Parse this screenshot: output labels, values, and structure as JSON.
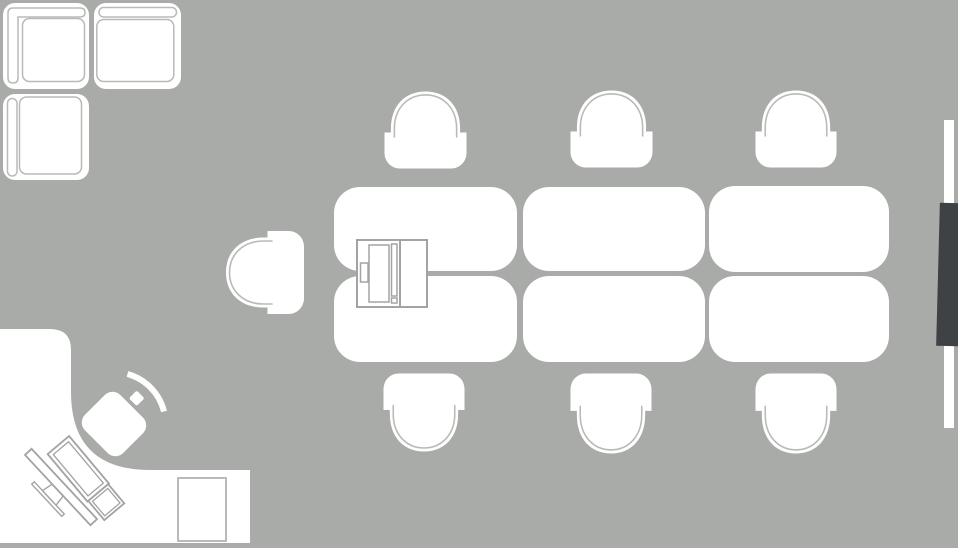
{
  "scene": {
    "label": "meeting-room-floor-plan",
    "canvas": {
      "width_px": 958,
      "height_px": 548
    },
    "furniture_inventory": [
      "corner-sofa (3 modules)",
      "lounge-chair",
      "conference-table (6 segments)",
      "6 conference chairs",
      "printer",
      "l-shaped-desk",
      "office-chair",
      "monitor",
      "keyboard",
      "cabinet",
      "wall-board",
      "tv-screen"
    ]
  },
  "colors": {
    "floor": "#a9aba8",
    "furniture": "#ffffff",
    "outline_light": "#b9bab8",
    "outline_mid": "#a2a4a2",
    "tv_screen": "#3f4245"
  },
  "items": {
    "sofa-corner-module": {
      "left": 3,
      "top": 3,
      "width": 86,
      "height": 86
    },
    "sofa-right-module": {
      "left": 94,
      "top": 3,
      "width": 87,
      "height": 86
    },
    "sofa-bottom-module": {
      "left": 3,
      "top": 94,
      "width": 86,
      "height": 86
    },
    "lounge-chair": {
      "left": 223,
      "top": 233,
      "width": 84,
      "height": 79
    },
    "table-top-1": {
      "left": 334,
      "top": 187,
      "width": 183,
      "height": 84
    },
    "table-top-2": {
      "left": 523,
      "top": 187,
      "width": 182,
      "height": 84
    },
    "table-top-3": {
      "left": 709,
      "top": 186,
      "width": 180,
      "height": 86
    },
    "table-bottom-1": {
      "left": 334,
      "top": 276,
      "width": 183,
      "height": 86
    },
    "table-bottom-2": {
      "left": 523,
      "top": 276,
      "width": 182,
      "height": 86
    },
    "table-bottom-3": {
      "left": 709,
      "top": 276,
      "width": 180,
      "height": 86
    },
    "chair-top-1": {
      "left": 384,
      "top": 91,
      "width": 83,
      "height": 78
    },
    "chair-top-2": {
      "left": 570,
      "top": 90,
      "width": 83,
      "height": 78
    },
    "chair-top-3": {
      "left": 755,
      "top": 90,
      "width": 82,
      "height": 78
    },
    "chair-bottom-1": {
      "left": 383,
      "top": 373,
      "width": 82,
      "height": 79
    },
    "chair-bottom-2": {
      "left": 570,
      "top": 373,
      "width": 82,
      "height": 81
    },
    "chair-bottom-3": {
      "left": 755,
      "top": 373,
      "width": 82,
      "height": 81
    },
    "printer": {
      "left": 356,
      "top": 239,
      "width": 72,
      "height": 69
    },
    "desk": {
      "left": 0,
      "top": 320,
      "width": 260,
      "height": 228
    },
    "office-chair": {
      "left": 60,
      "top": 360,
      "width": 120,
      "height": 110
    },
    "desk-monitor": {
      "left": 15,
      "top": 442,
      "width": 95,
      "height": 92
    },
    "desk-keyboard": {
      "left": 40,
      "top": 430,
      "width": 100,
      "height": 100
    },
    "cabinet": {
      "left": 177,
      "top": 477,
      "width": 50,
      "height": 65
    },
    "wall-board": {
      "left": 944,
      "top": 120,
      "width": 10,
      "height": 308
    },
    "tv-screen": {
      "left": 938,
      "top": 203,
      "width": 22,
      "height": 143
    }
  }
}
